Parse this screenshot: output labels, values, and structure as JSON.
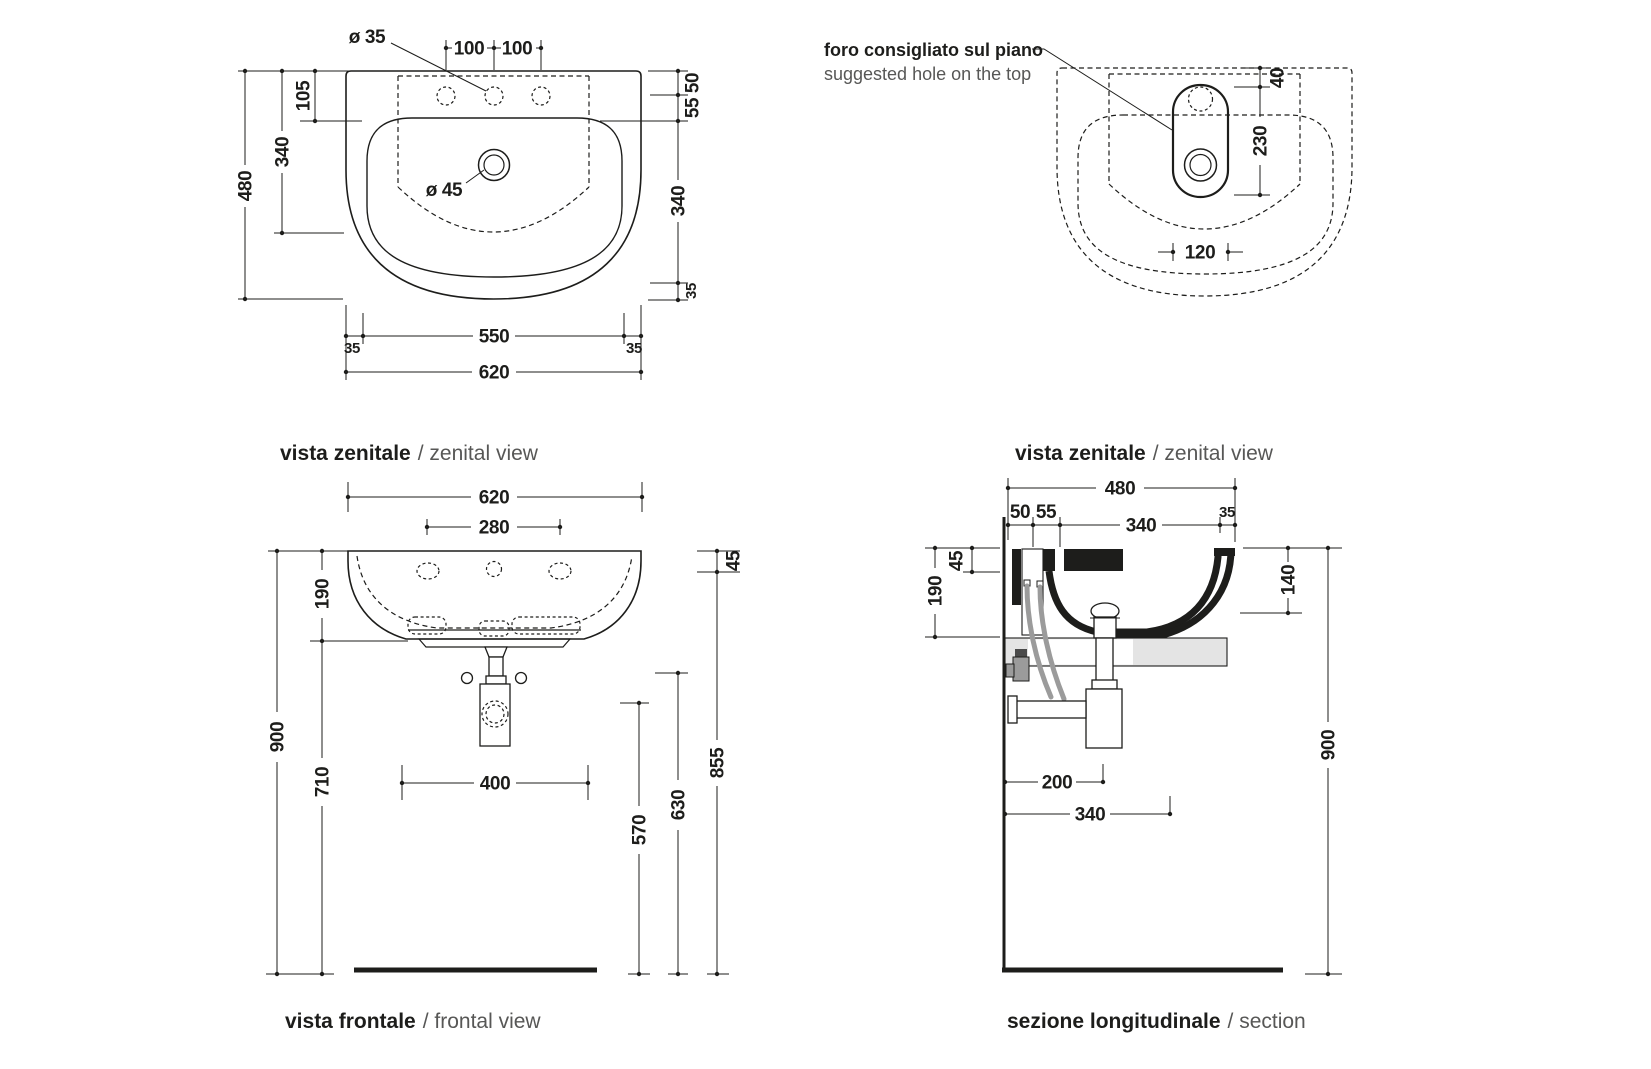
{
  "colors": {
    "ink": "#1d1d1b",
    "muted_text": "#575756",
    "pipe_gray": "#9b9b9b",
    "slab_gray": "#e4e4e4",
    "paper": "#ffffff"
  },
  "views": {
    "plan": {
      "caption_bold": "vista zenitale",
      "caption_regular": "/ zenital view",
      "labels": {
        "faucet_hole_diameter": "ø 35",
        "drain_diameter": "ø 45"
      },
      "dims": {
        "hole_spacing_left": "100",
        "hole_spacing_right": "100",
        "d105": "105",
        "d340_left": "340",
        "d480": "480",
        "d50": "50",
        "d55": "55",
        "d340_right": "340",
        "d35_right": "35",
        "d550": "550",
        "d35_bottom_left": "35",
        "d35_bottom_right": "35",
        "d620": "620"
      }
    },
    "hole_plan": {
      "note_bold": "foro consigliato sul piano",
      "note_regular": "suggested hole on the top",
      "caption_bold": "vista zenitale",
      "caption_regular": "/ zenital view",
      "dims": {
        "d40": "40",
        "d230": "230",
        "d120": "120"
      }
    },
    "front": {
      "caption_bold": "vista frontale",
      "caption_regular": "/ frontal view",
      "dims": {
        "d620": "620",
        "d280": "280",
        "d190": "190",
        "d900": "900",
        "d710": "710",
        "d45": "45",
        "d400": "400",
        "d570": "570",
        "d630": "630",
        "d855": "855"
      }
    },
    "section": {
      "caption_bold": "sezione longitudinale",
      "caption_regular": "/ section",
      "dims": {
        "d480": "480",
        "d50": "50",
        "d55": "55",
        "d340_top": "340",
        "d35": "35",
        "d45": "45",
        "d190": "190",
        "d140": "140",
        "d200": "200",
        "d340_bottom": "340",
        "d900": "900"
      }
    }
  }
}
